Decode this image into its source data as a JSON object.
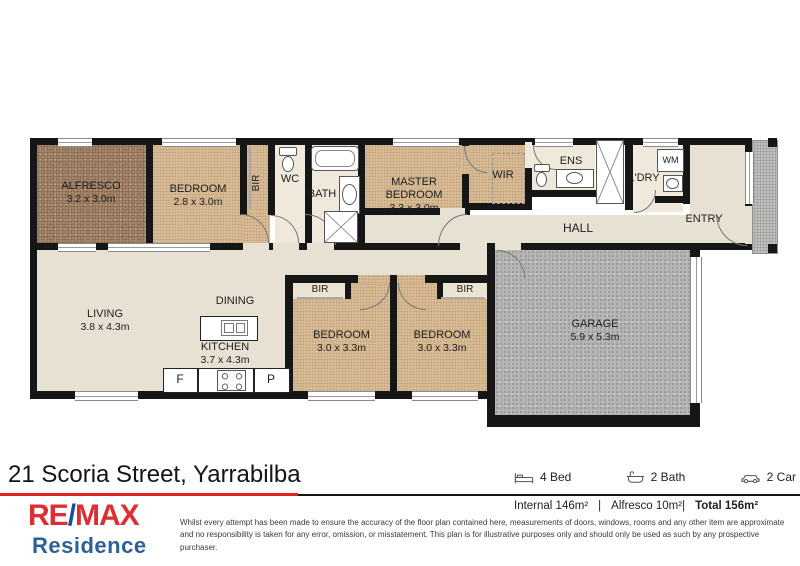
{
  "address": "21 Scoria Street, Yarrabilba",
  "plan": {
    "rooms": {
      "alfresco": {
        "name": "ALFRESCO",
        "dims": "3.2 x 3.0m"
      },
      "bedroom2": {
        "name": "BEDROOM",
        "dims": "2.8 x 3.0m"
      },
      "bir1": {
        "name": "BIR"
      },
      "wc": {
        "name": "WC"
      },
      "bath": {
        "name": "BATH"
      },
      "master": {
        "name": "MASTER",
        "name2": "BEDROOM",
        "dims": "3.3 x 3.0m"
      },
      "wir": {
        "name": "WIR"
      },
      "ens": {
        "name": "ENS"
      },
      "ldry": {
        "name": "L'DRY"
      },
      "wm": {
        "name": "WM"
      },
      "entry": {
        "name": "ENTRY"
      },
      "hall": {
        "name": "HALL"
      },
      "living": {
        "name": "LIVING",
        "dims": "3.8 x 4.3m"
      },
      "dining": {
        "name": "DINING"
      },
      "kitchen": {
        "name": "KITCHEN",
        "dims": "3.7 x 4.3m"
      },
      "bir3": {
        "name": "BIR"
      },
      "bir4": {
        "name": "BIR"
      },
      "bedroom3": {
        "name": "BEDROOM",
        "dims": "3.0 x 3.3m"
      },
      "bedroom4": {
        "name": "BEDROOM",
        "dims": "3.0 x 3.3m"
      },
      "garage": {
        "name": "GARAGE",
        "dims": "5.9 x 5.3m"
      },
      "fridge": {
        "name": "F"
      },
      "pantry": {
        "name": "P"
      }
    }
  },
  "summary": {
    "beds_label": "4 Bed",
    "baths_label": "2 Bath",
    "cars_label": "2 Car",
    "internal": "Internal 146m²",
    "separator": "|",
    "alfresco_area": "Alfresco 10m²|",
    "total": "Total 156m²"
  },
  "brand": {
    "re": "RE",
    "slash": "/",
    "max": "MAX",
    "residence": "Residence"
  },
  "disclaimer": "Whilst every attempt has been made to ensure the accuracy of the floor plan contained here, measurements of doors, windows, rooms and any other item are approximate and no responsibility is taken for any error, omission, or misstatement. This plan is for illustrative purposes only and should only be used as such by any prospective purchaser.",
  "colors": {
    "remax_red": "#dc2f34",
    "remax_blue": "#1d4fa1",
    "residence_blue": "#2e6096",
    "underline_red": "#e3241d"
  }
}
